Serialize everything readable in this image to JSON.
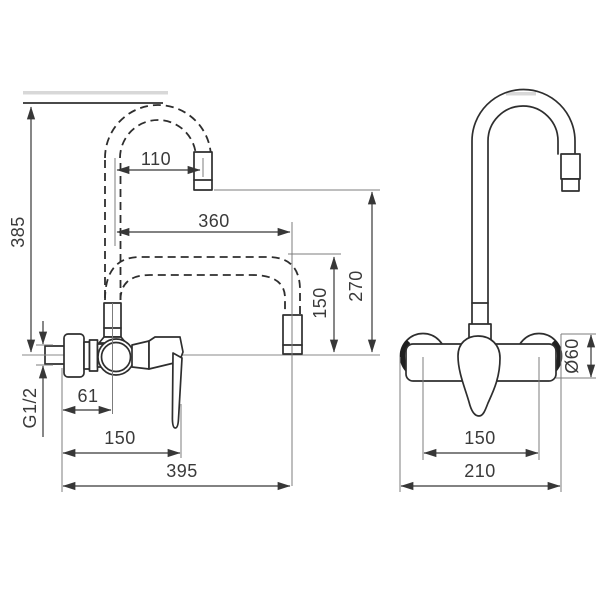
{
  "drawing": {
    "type": "faucet-technical-dimension-drawing",
    "line_color": "#2e2e2e",
    "dim_color": "#373737",
    "shade_color": "#d8d8d8",
    "dims": {
      "side": {
        "height_overall": "385",
        "spout_proj_top": "110",
        "spout_proj_max": "360",
        "spout_h_upper": "270",
        "spout_h_lower": "150",
        "wall_offset": "61",
        "depth_body": "150",
        "depth_overall": "395",
        "thread": "G1/2"
      },
      "front": {
        "rosette_d": "Ø60",
        "centers": "150",
        "width_overall": "210"
      }
    }
  }
}
